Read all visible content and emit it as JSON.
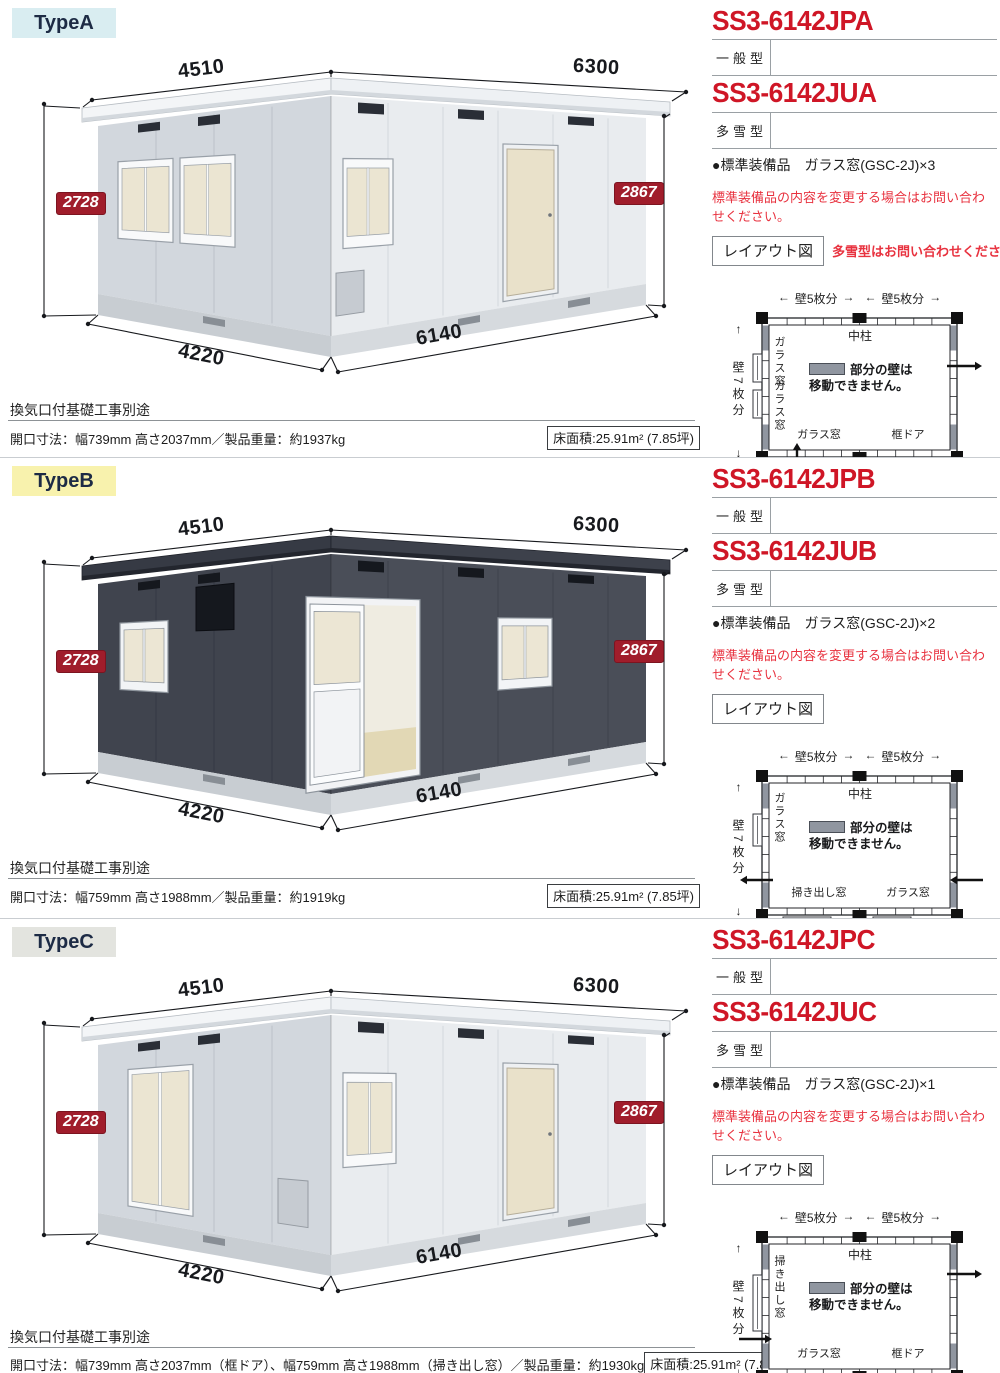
{
  "shared": {
    "dims": {
      "width_back": "4510",
      "width_front": "6300",
      "height_left": "2728",
      "height_right": "2867",
      "depth_front": "4220",
      "length_front": "6140"
    },
    "notes": {
      "vent": "換気口付基礎工事別途"
    },
    "warning": "標準装備品の内容を変更する場合はお問い合わせください。",
    "layout_button": "レイアウト図",
    "plan": {
      "wall5": "壁5枚分",
      "wall7": "壁7枚分",
      "pillar": "中柱",
      "legend_line1": "部分の壁は",
      "legend_line2": "移動できません。",
      "arrow_left": "←",
      "arrow_right": "→",
      "arrow_up": "↑",
      "arrow_down": "↓"
    }
  },
  "sections": [
    {
      "type_label": "TypeA",
      "type_bg": "#d9edf1",
      "model_general": "SS3-6142JPA",
      "general_type": "一般型",
      "model_snow": "SS3-6142JUA",
      "snow_type": "多雪型",
      "equipment_label": "●標準装備品",
      "equipment_value": "ガラス窓(GSC-2J)×3",
      "layout_note": "多雪型はお問い合わせください。",
      "spec": "開口寸法：幅739mm 高さ2037mm／製品重量：約1937kg",
      "floor_area": "床面積:25.91m² (7.85坪)",
      "building": {
        "variant": "A",
        "colors": {
          "fascia": "#f3f5f7",
          "fascia2": "#eef1f4",
          "fasciaStroke": "#b6bcc2",
          "lip": "#d3d8dd",
          "left": "#d2d7dd",
          "front": "#e9ecef",
          "plinth": "#c8cdd2",
          "plinth2": "#d6dade",
          "seam": "#bcc2c9",
          "seamF": "#d2d7dc",
          "vent": "#2a2e36",
          "pvent": "#888e95",
          "frame": "#f8f9fa",
          "frameStroke": "#99a0a8",
          "glass": "#ebe5d2",
          "door": "#e9e1ca"
        }
      },
      "plan": {
        "variant": "A",
        "left_labels": [
          "ガラス窓",
          "ガラス窓"
        ],
        "bottom_left": "ガラス窓",
        "bottom_right": "框ドア"
      }
    },
    {
      "type_label": "TypeB",
      "type_bg": "#f8f2ad",
      "model_general": "SS3-6142JPB",
      "general_type": "一般型",
      "model_snow": "SS3-6142JUB",
      "snow_type": "多雪型",
      "equipment_label": "●標準装備品",
      "equipment_value": "ガラス窓(GSC-2J)×2",
      "spec": "開口寸法：幅759mm 高さ1988mm／製品重量：約1919kg",
      "floor_area": "床面積:25.91m² (7.85坪)",
      "building": {
        "variant": "B",
        "colors": {
          "fascia": "#363a44",
          "fascia2": "#3d414b",
          "fasciaStroke": "#20232b",
          "lip": "#23262e",
          "left": "#40444e",
          "front": "#4a4e58",
          "plinth": "#c8cdd2",
          "plinth2": "#d6dade",
          "seam": "#353944",
          "seamF": "#3f434d",
          "vent": "#15181e",
          "pvent": "#888e95",
          "frame": "#f2f4f6",
          "frameStroke": "#8d949c",
          "glass": "#ece6d4",
          "door": "#e9e1ca",
          "interiorWall": "#efece1",
          "interiorFloor": "#e2d8b5"
        }
      },
      "plan": {
        "variant": "B",
        "left_labels": [
          "ガラス窓"
        ],
        "bottom_left": "掃き出し窓",
        "bottom_right": "ガラス窓"
      }
    },
    {
      "type_label": "TypeC",
      "type_bg": "#e3e4df",
      "model_general": "SS3-6142JPC",
      "general_type": "一般型",
      "model_snow": "SS3-6142JUC",
      "snow_type": "多雪型",
      "equipment_label": "●標準装備品",
      "equipment_value": "ガラス窓(GSC-2J)×1",
      "spec": "開口寸法：幅739mm 高さ2037mm（框ドア）、幅759mm 高さ1988mm（掃き出し窓）／製品重量：約1930kg",
      "floor_area": "床面積:25.91m² (7.85坪)",
      "building": {
        "variant": "C",
        "colors": {
          "fascia": "#f3f5f7",
          "fascia2": "#eef1f4",
          "fasciaStroke": "#b6bcc2",
          "lip": "#d3d8dd",
          "left": "#d2d7dd",
          "front": "#e9ecef",
          "plinth": "#c8cdd2",
          "plinth2": "#d6dade",
          "seam": "#bcc2c9",
          "seamF": "#d2d7dc",
          "vent": "#2a2e36",
          "pvent": "#888e95",
          "frame": "#f8f9fa",
          "frameStroke": "#99a0a8",
          "glass": "#ebe5d2",
          "door": "#e9e1ca"
        }
      },
      "plan": {
        "variant": "C",
        "left_labels": [
          "掃き出し窓"
        ],
        "bottom_left": "ガラス窓",
        "bottom_right": "框ドア"
      }
    }
  ]
}
